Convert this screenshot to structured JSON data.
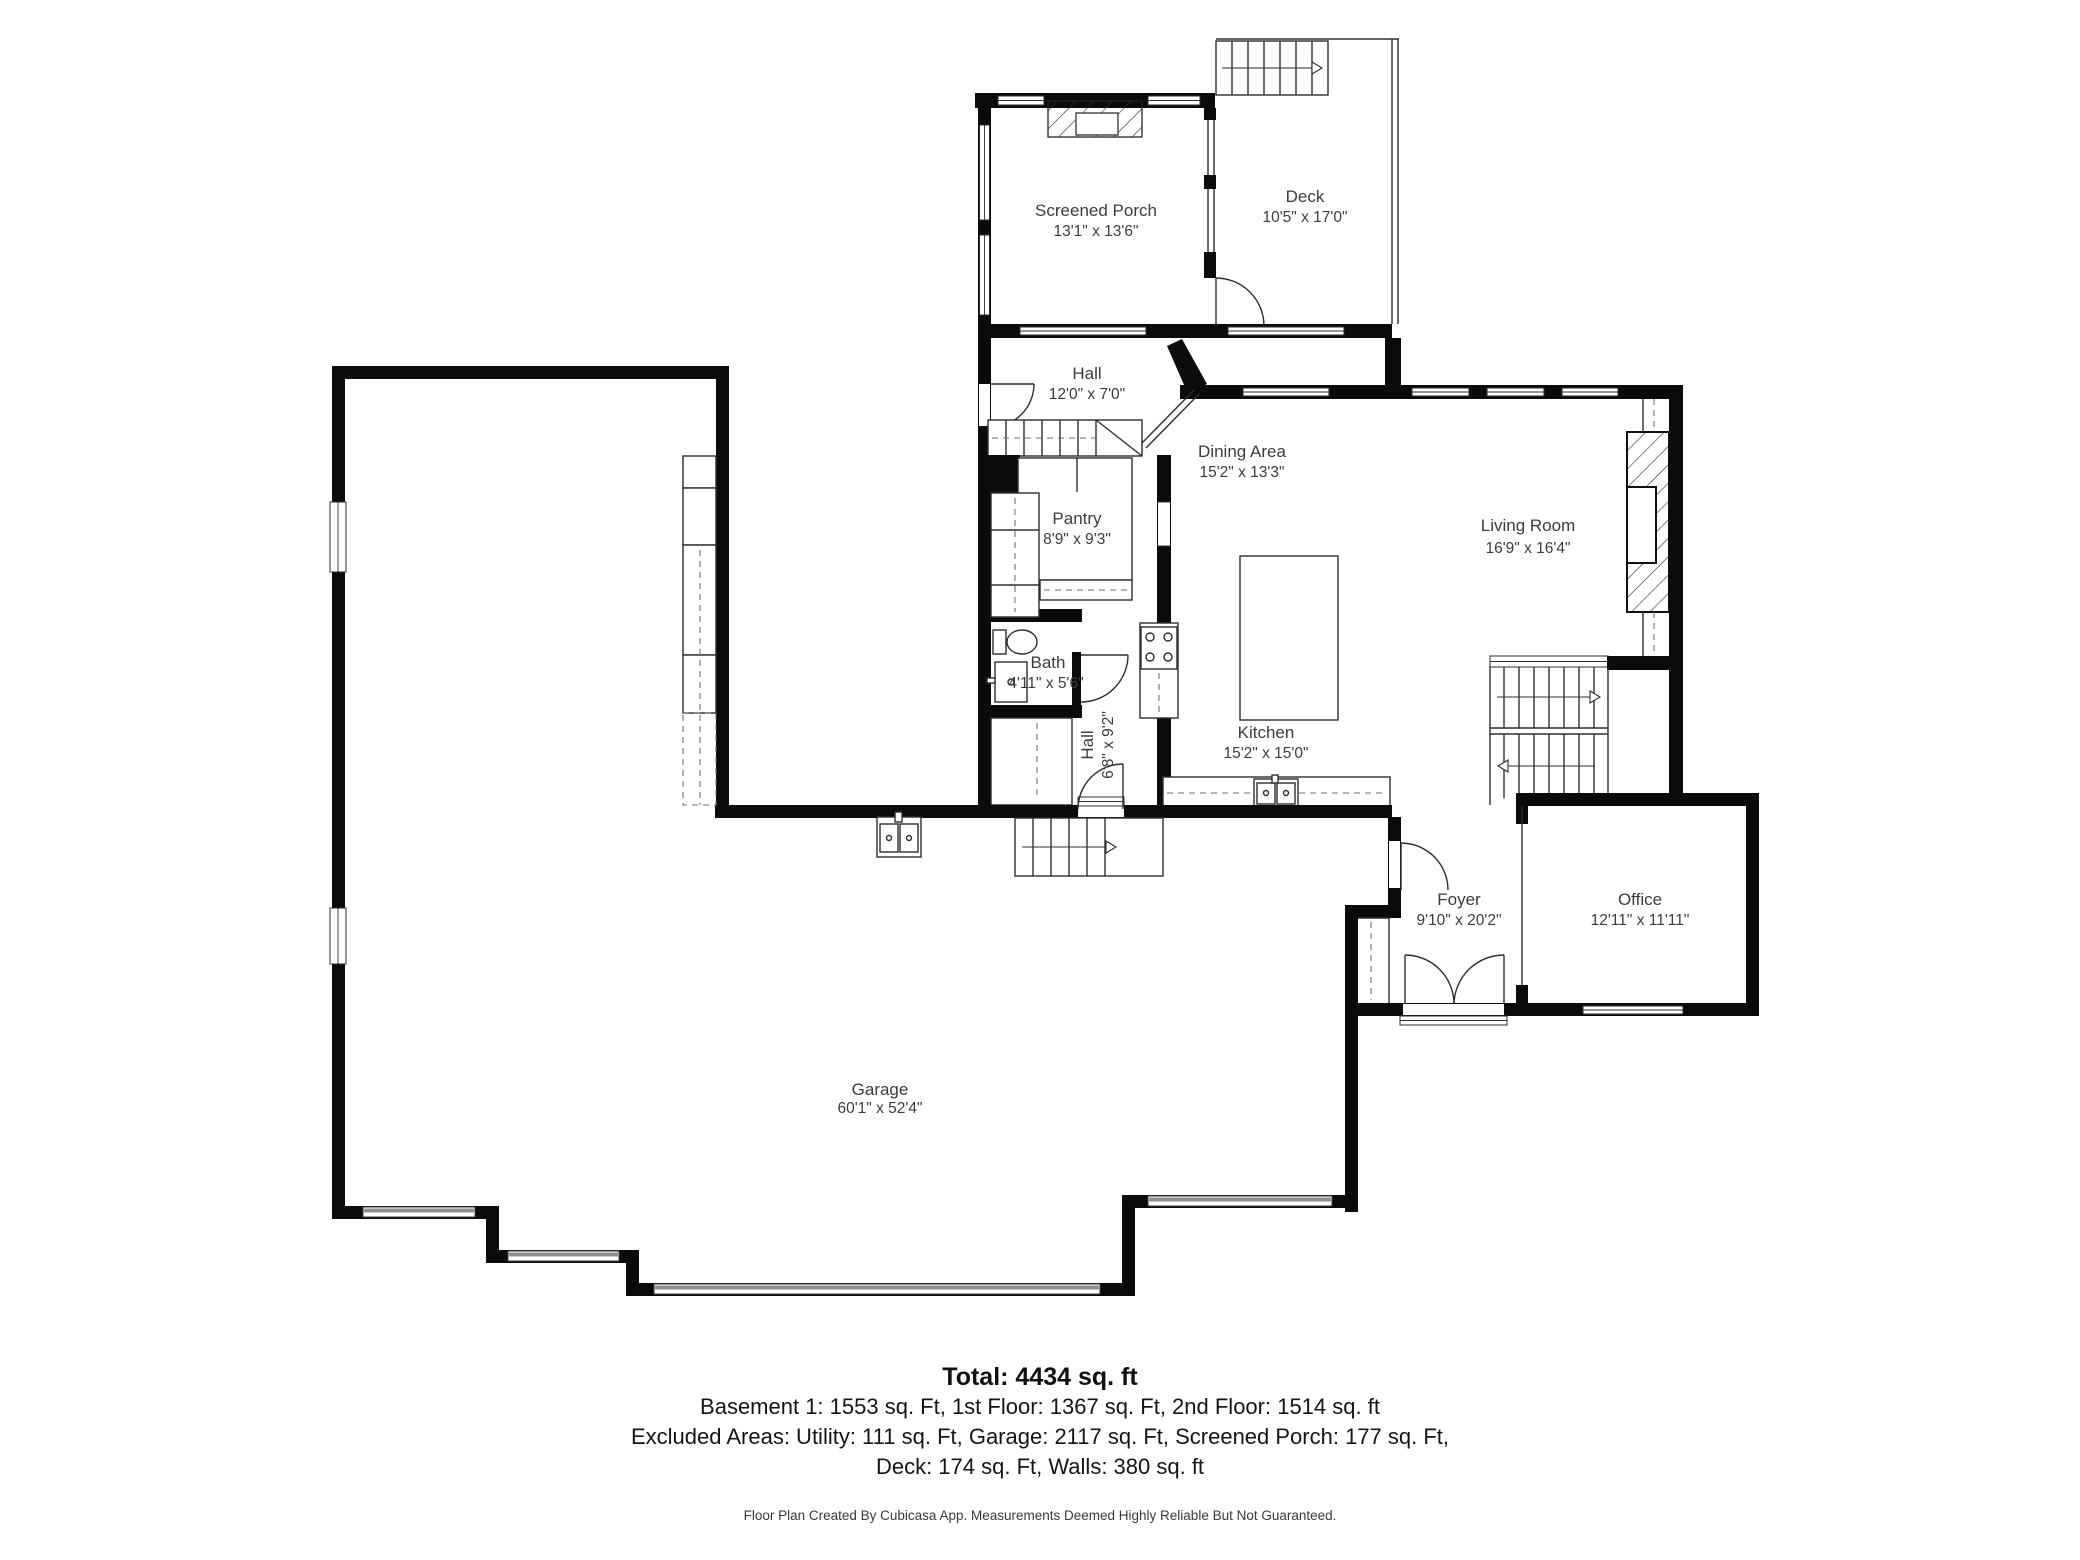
{
  "rooms": {
    "screened_porch": {
      "name": "Screened Porch",
      "dims": "13'1\" x 13'6\""
    },
    "deck": {
      "name": "Deck",
      "dims": "10'5\" x 17'0\""
    },
    "hall_upper": {
      "name": "Hall",
      "dims": "12'0\" x 7'0\""
    },
    "dining_area": {
      "name": "Dining Area",
      "dims": "15'2\" x 13'3\""
    },
    "living_room": {
      "name": "Living Room",
      "dims": "16'9\" x 16'4\""
    },
    "pantry": {
      "name": "Pantry",
      "dims": "8'9\" x 9'3\""
    },
    "bath": {
      "name": "Bath",
      "dims": "4'11\" x 5'6\""
    },
    "hall_lower": {
      "name": "Hall",
      "dims": "6'8\" x 9'2\""
    },
    "kitchen": {
      "name": "Kitchen",
      "dims": "15'2\" x 15'0\""
    },
    "foyer": {
      "name": "Foyer",
      "dims": "9'10\" x 20'2\""
    },
    "office": {
      "name": "Office",
      "dims": "12'11\" x 11'11\""
    },
    "garage": {
      "name": "Garage",
      "dims": "60'1\" x 52'4\""
    }
  },
  "summary": {
    "total": "Total: 4434 sq. ft",
    "floors": "Basement 1: 1553 sq. Ft, 1st Floor: 1367 sq. Ft, 2nd Floor: 1514 sq. ft",
    "excluded_line1": "Excluded Areas: Utility: 111 sq. Ft, Garage: 2117 sq. Ft, Screened Porch: 177 sq. Ft,",
    "excluded_line2": "Deck: 174 sq. Ft, Walls: 380 sq. ft"
  },
  "disclaimer": "Floor Plan Created By Cubicasa App. Measurements Deemed Highly Reliable But Not Guaranteed.",
  "colors": {
    "wall": "#0b0b0b",
    "text": "#3c3c3c",
    "garage_door": "#8f8f8f"
  }
}
